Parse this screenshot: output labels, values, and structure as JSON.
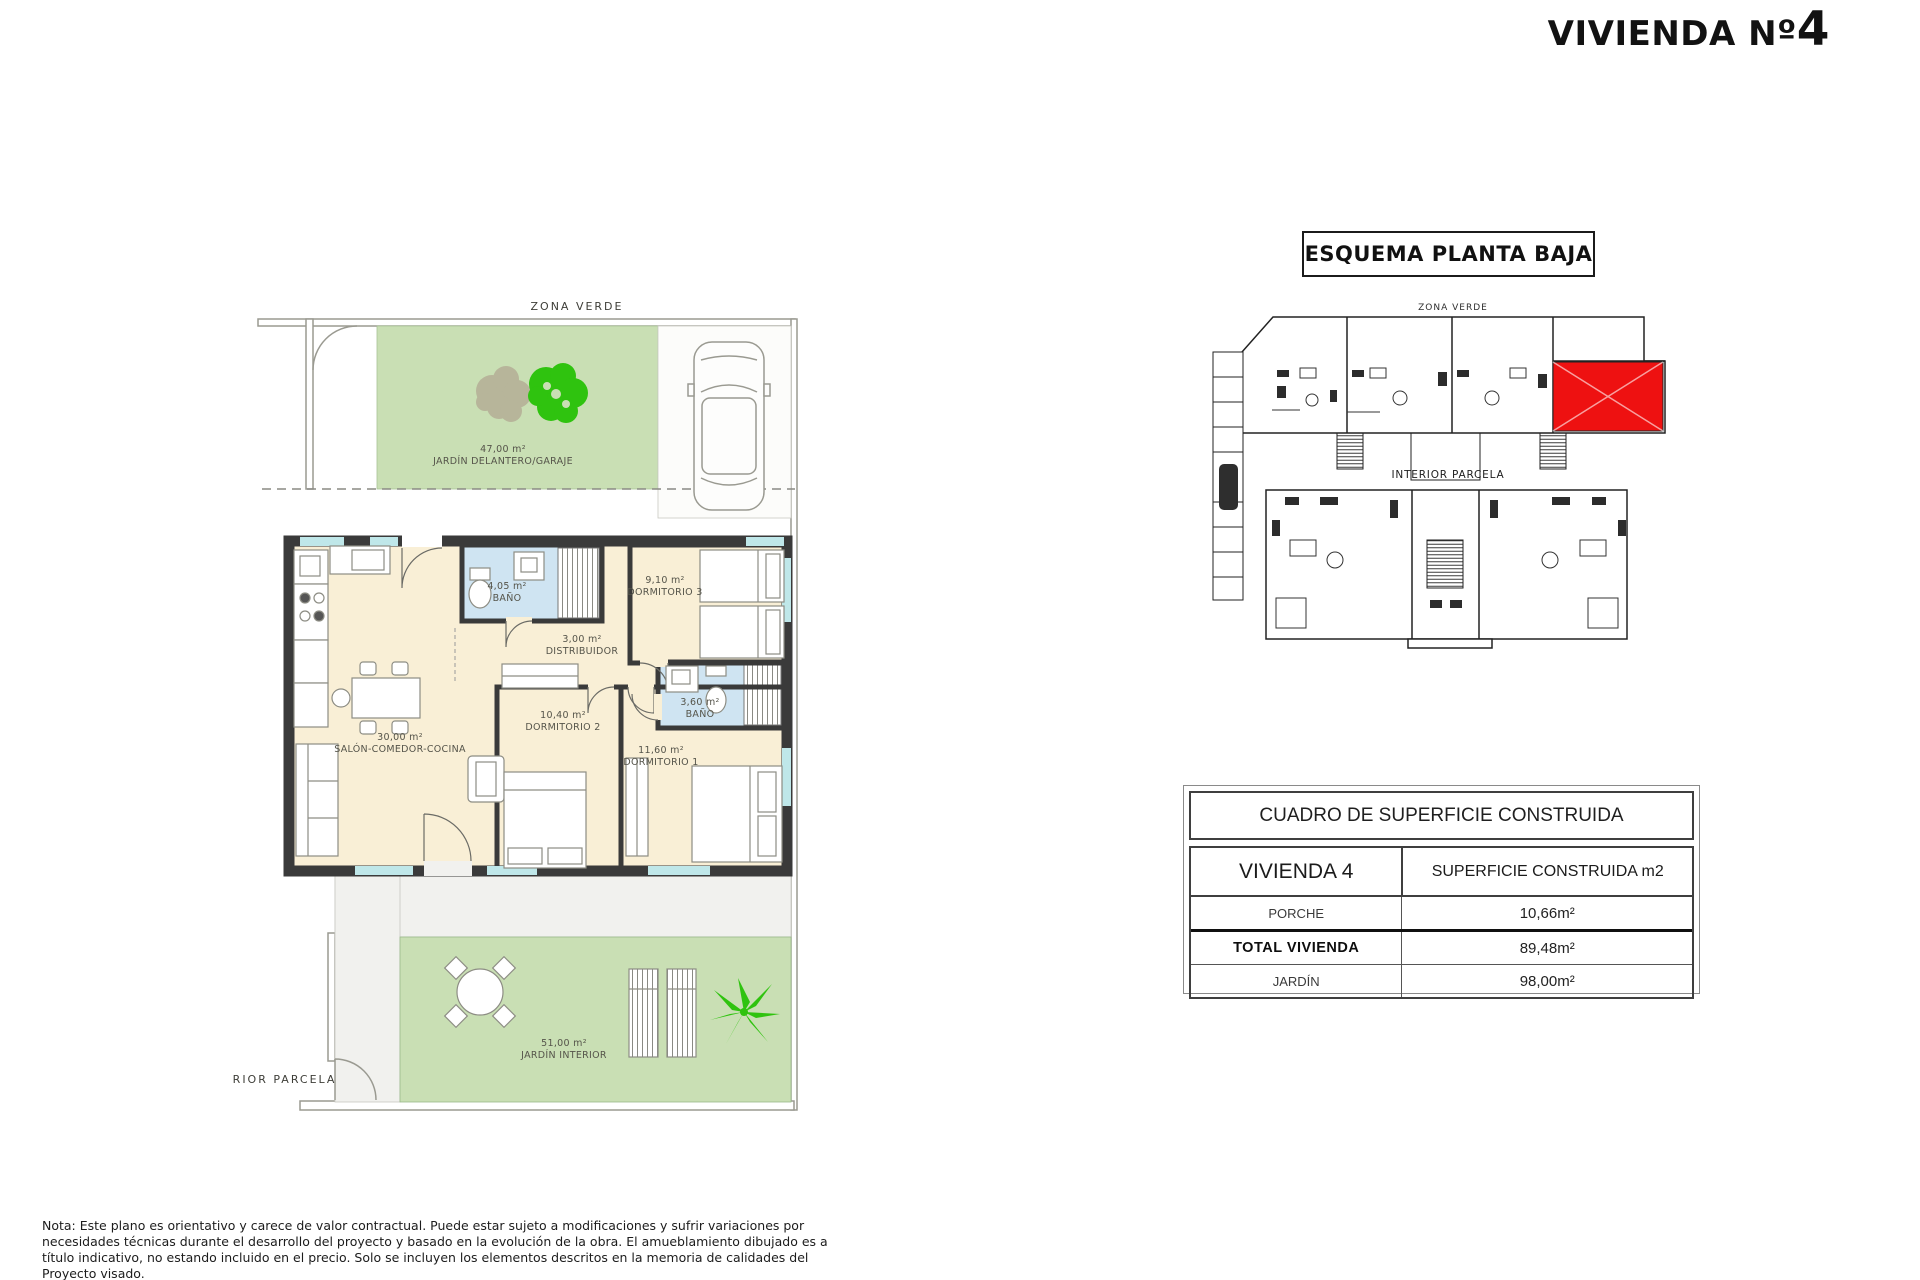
{
  "page": {
    "title_prefix": "VIVIENDA Nº",
    "title_number": "4"
  },
  "main_plan": {
    "zona_verde_label": "ZONA VERDE",
    "interior_parcela_label": "INTERIOR PARCELA",
    "rooms": [
      {
        "area": "47,00 m²",
        "name": "JARDÍN DELANTERO/GARAJE"
      },
      {
        "area": "4,05 m²",
        "name": "BAÑO"
      },
      {
        "area": "9,10 m²",
        "name": "DORMITORIO 3"
      },
      {
        "area": "3,00 m²",
        "name": "DISTRIBUIDOR"
      },
      {
        "area": "10,40 m²",
        "name": "DORMITORIO 2"
      },
      {
        "area": "3,60 m²",
        "name": "BAÑO"
      },
      {
        "area": "11,60 m²",
        "name": "DORMITORIO 1"
      },
      {
        "area": "30,00 m²",
        "name": "SALÓN-COMEDOR-COCINA"
      },
      {
        "area": "51,00 m²",
        "name": "JARDÍN INTERIOR"
      }
    ]
  },
  "site_plan": {
    "title": "ESQUEMA PLANTA BAJA",
    "zona_verde_label": "ZONA VERDE",
    "interior_parcela_label": "INTERIOR PARCELA"
  },
  "surface_table": {
    "title": "CUADRO DE SUPERFICIE CONSTRUIDA",
    "col1_header": "VIVIENDA 4",
    "col2_header": "SUPERFICIE CONSTRUIDA m2",
    "rows": [
      {
        "label": "PORCHE",
        "value": "10,66m²"
      },
      {
        "label": "TOTAL VIVIENDA",
        "value": "89,48m²"
      },
      {
        "label": "JARDÍN",
        "value": "98,00m²"
      }
    ]
  },
  "notes": {
    "spanish": "Nota: Este plano es orientativo y carece de valor contractual. Puede estar sujeto a modificaciones y sufrir variaciones por necesidades técnicas durante el desarrollo del proyecto y basado en la evolución de la obra. El amueblamiento dibujado es a título indicativo, no estando incluido en el precio. Solo se incluyen los elementos descritos en la memoria de calidades del Proyecto visado.",
    "english": "Note: This plan is indicative and has no contractual value. It may be subject to modifications and may undergo variations due to technical needs"
  },
  "colors": {
    "garden_green": "#c9dfb4",
    "tree_green": "#2fc30f",
    "tree_gray": "#b7b59a",
    "room_cream": "#f9efd6",
    "bath_blue": "#cfe4f2",
    "wall_dark": "#3a3a3a",
    "window_cyan": "#bfe7e9",
    "highlight_red": "#ee1111"
  }
}
